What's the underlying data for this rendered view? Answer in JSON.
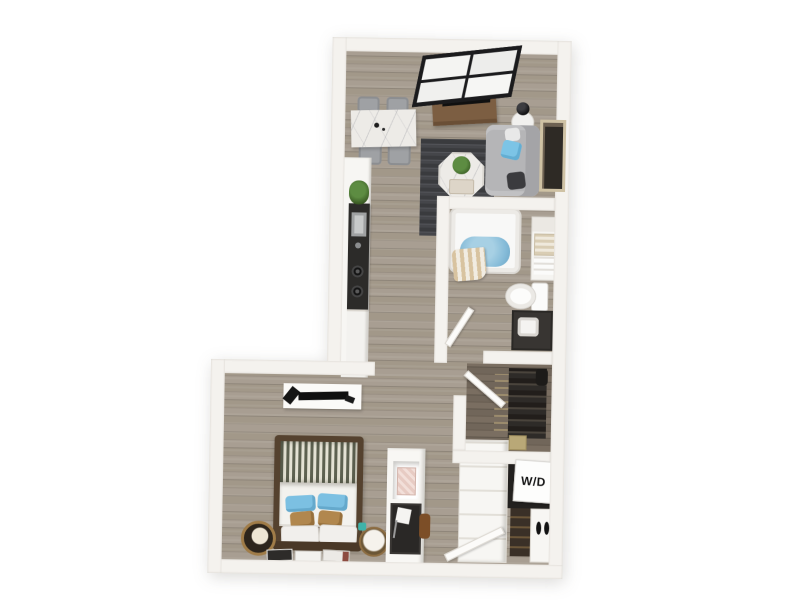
{
  "image": {
    "kind": "3d-rendered-floor-plan",
    "description": "Top-down 3D floor plan of a studio apartment with living-dining area, galley kitchen, bathroom, walk-in closet, laundry nook and bedroom"
  },
  "labels": {
    "washer_dryer": "W/D"
  },
  "palette": {
    "background": "#ffffff",
    "wall": "#f4f2ee",
    "floor_wood": "#a69c90",
    "floor_wood_dark": "#75695c",
    "kitchen_counter": "#2c2b29",
    "rug": "#404144",
    "sofa": "#b5b5b7",
    "accent_blue": "#7cc4e6",
    "pillow_tan": "#b1874e",
    "console_wood": "#7c5e42",
    "bed_frame": "#55422f",
    "tub_water": "#85bbd8",
    "plant_green": "#4c7a35",
    "window_frame": "#1b1b1d"
  },
  "items": [
    "window",
    "dining-table",
    "dining-chairs",
    "tv-console",
    "tv",
    "side-table",
    "table-lamp",
    "sofa",
    "wall-art",
    "area-rug",
    "coffee-table",
    "kitchen-counter",
    "kitchen-sink",
    "stove-burners",
    "bathtub",
    "shower-curtain",
    "bathroom-shelf",
    "toilet",
    "bathroom-vanity",
    "closet-clothes",
    "washer-dryer",
    "linen-cabinet",
    "shoe-rack",
    "shoe-cabinet",
    "bed",
    "nightstands",
    "media-shelf",
    "desk-partition",
    "entry-door"
  ]
}
